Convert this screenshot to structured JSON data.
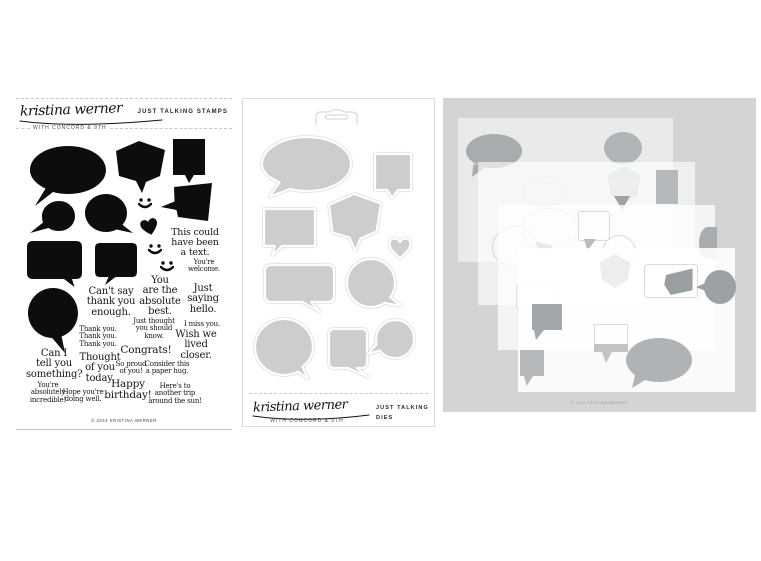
{
  "brand": {
    "signature": "kristina werner",
    "tagline": "WITH CONCORD & 9TH",
    "copyright": "© 2024 KRISTINA WERNER"
  },
  "stamps_panel": {
    "title": "JUST TALKING STAMPS",
    "sentiments": [
      "This could\nhave been\na text.",
      "You're\nwelcome.",
      "You\nare the\nabsolute\nbest.",
      "Just\nsaying\nhello.",
      "Can't say\nthank you\nenough.",
      "Just thought\nyou should\nknow.",
      "I miss you.",
      "Thank you.\nThank you.\nThank you.",
      "Wish we\nlived\ncloser.",
      "Congrats!",
      "Can I\ntell you\nsomething?",
      "Thought\nof you\ntoday.",
      "So proud\nof you!",
      "Consider this\na paper hug.",
      "You're\nabsolutely\nincredible!",
      "Hope you're\ndoing well.",
      "Happy\nbirthday!",
      "Here's to\nanother trip\naround the sun!"
    ]
  },
  "dies_panel": {
    "title": "JUST TALKING\nDIES"
  },
  "display_panel": {
    "copyright": "© 2024 KRISTINA WERNER"
  },
  "colors": {
    "stamp_ink": "#0d0d0d",
    "die_fill": "#cbcdce",
    "display_bg": "#d2d4d5",
    "line_gray": "#c6c8c9"
  }
}
